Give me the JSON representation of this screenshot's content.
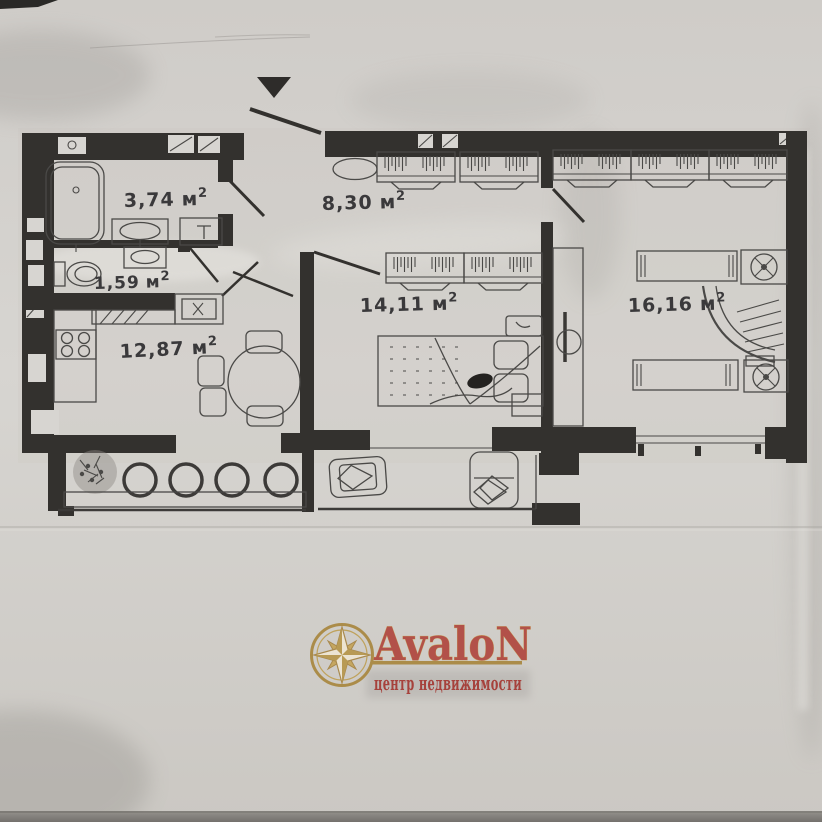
{
  "document": {
    "kind": "scanned apartment floor plan photo"
  },
  "rooms": {
    "bathroom": {
      "value": "3,74",
      "unit": "м",
      "sup": "2"
    },
    "hallway": {
      "value": "8,30",
      "unit": "м",
      "sup": "2"
    },
    "wc": {
      "value": "1,59",
      "unit": "м",
      "sup": "2"
    },
    "living": {
      "value": "14,11",
      "unit": "м",
      "sup": "2"
    },
    "kitchen": {
      "value": "12,87",
      "unit": "м",
      "sup": "2"
    },
    "bedroom": {
      "value": "16,16",
      "unit": "м",
      "sup": "2"
    }
  },
  "logo": {
    "name": "AvaloN",
    "tagline": "центр недвижимости",
    "colors": {
      "gold": "#ab8c49",
      "name_red": "#b25149",
      "tagline_red": "#a6423c"
    }
  },
  "colors": {
    "paper": "#d4d2ce",
    "wall": "#33312e",
    "furniture_line": "#4a4947",
    "label_text": "#3a393b"
  }
}
